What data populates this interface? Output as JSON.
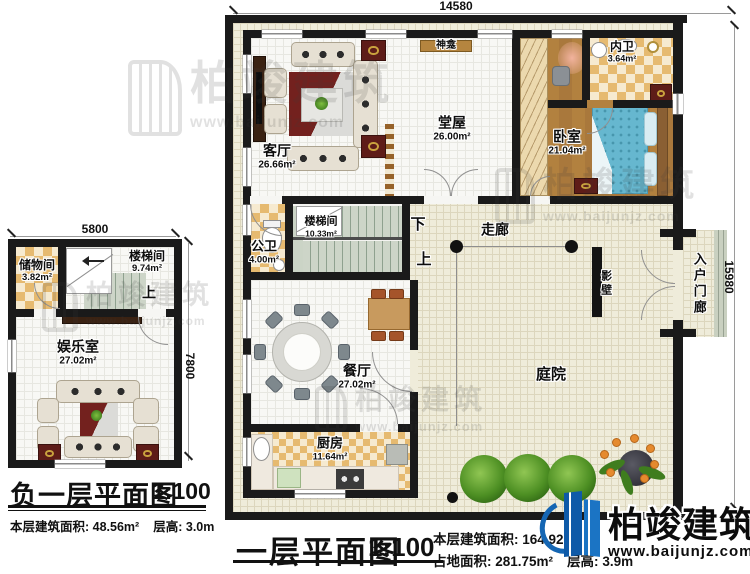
{
  "plans": {
    "main": {
      "dim_width": "14580",
      "dim_height": "15980",
      "rooms": {
        "living": {
          "name": "客厅",
          "area": "26.66m²"
        },
        "hall": {
          "name": "堂屋",
          "area": "26.00m²"
        },
        "shrine": {
          "name": "神龛"
        },
        "bedroom": {
          "name": "卧室",
          "area": "21.04m²"
        },
        "ensuite": {
          "name": "内卫",
          "area": "3.64m²"
        },
        "stairwell": {
          "name": "楼梯间",
          "area": "10.33m²"
        },
        "bath": {
          "name": "公卫",
          "area": "4.00m²"
        },
        "corridor": {
          "name": "走廊"
        },
        "screen_wall": {
          "name": "影壁"
        },
        "porch": {
          "name": "入户门廊"
        },
        "dining": {
          "name": "餐厅",
          "area": "27.02m²"
        },
        "kitchen": {
          "name": "厨房",
          "area": "11.64m²"
        },
        "courtyard": {
          "name": "庭院"
        }
      },
      "stair_down": "下",
      "stair_up": "上",
      "caption": {
        "title": "一层平面图",
        "scale": "1:100",
        "floor_area_label": "本层建筑面积:",
        "floor_area_value": "164.92m²",
        "site_area_label": "占地面积:",
        "site_area_value": "281.75m²",
        "height_label": "层高:",
        "height_value": "3.9m"
      }
    },
    "basement": {
      "dim_width": "5800",
      "dim_height": "7800",
      "rooms": {
        "storage": {
          "name": "储物间",
          "area": "3.82m²"
        },
        "stairwell": {
          "name": "楼梯间",
          "area": "9.74m²"
        },
        "recreation": {
          "name": "娱乐室",
          "area": "27.02m²"
        }
      },
      "stair_up": "上",
      "caption": {
        "title": "负一层平面图",
        "scale": "1:100",
        "floor_area_label": "本层建筑面积:",
        "floor_area_value": "48.56m²",
        "height_label": "层高:",
        "height_value": "3.0m"
      }
    }
  },
  "brand": {
    "name": "柏竣建筑",
    "website": "www.baijunjz.com"
  },
  "watermark": {
    "name": "柏竣建筑",
    "website": "www.baijunjz.com"
  },
  "colors": {
    "brand_blue": "#1566b3",
    "wall_black": "#1a1a1a",
    "ground_beige": "#efecda",
    "wood_floor": "#b2813f",
    "tile_tan": "#e6ba70",
    "stair_sage": "#cdd5c8",
    "bed_blue": "#66b7cf",
    "rug_red": "#772220",
    "tree_green": "#4d8f23"
  }
}
